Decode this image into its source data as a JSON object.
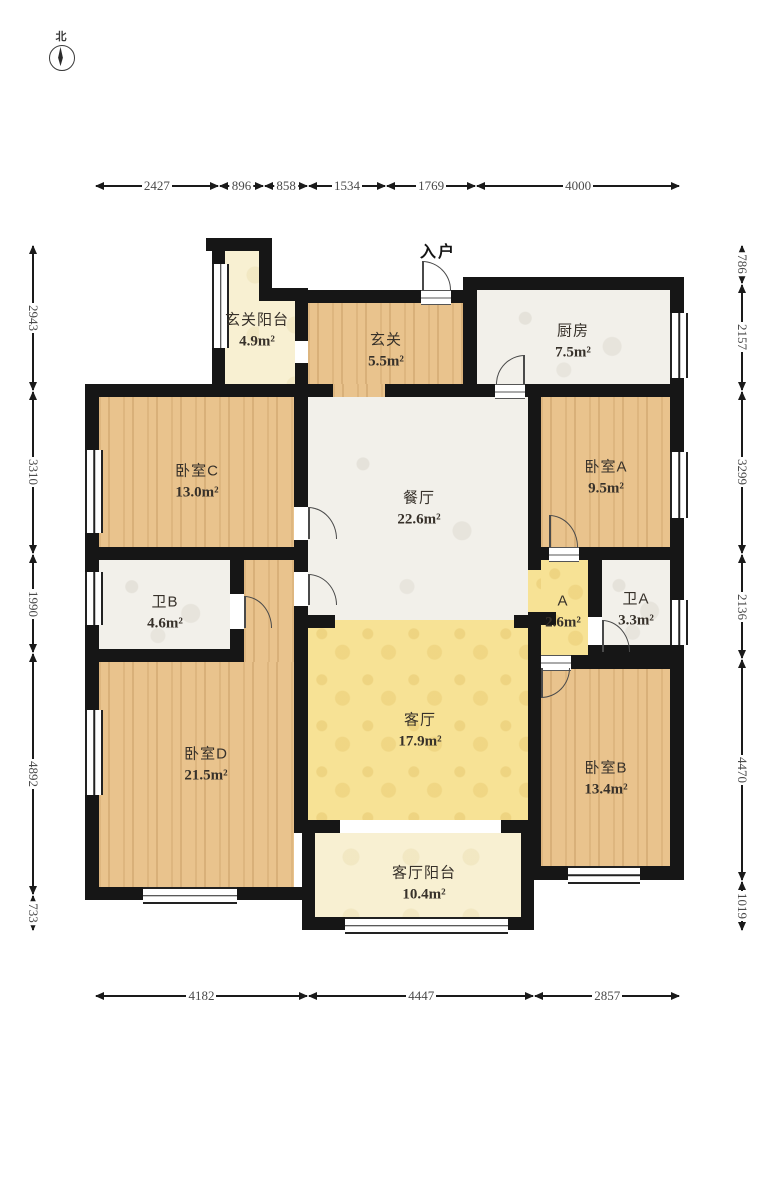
{
  "compass": {
    "north_label": "北"
  },
  "entry": {
    "label": "入户"
  },
  "rooms": [
    {
      "id": "xuanguan-yangtai",
      "name": "玄关阳台",
      "area": "4.9m²"
    },
    {
      "id": "xuanguan",
      "name": "玄关",
      "area": "5.5m²"
    },
    {
      "id": "chufang",
      "name": "厨房",
      "area": "7.5m²"
    },
    {
      "id": "woshi-c",
      "name": "卧室C",
      "area": "13.0m²"
    },
    {
      "id": "canting",
      "name": "餐厅",
      "area": "22.6m²"
    },
    {
      "id": "woshi-a",
      "name": "卧室A",
      "area": "9.5m²"
    },
    {
      "id": "wei-b",
      "name": "卫B",
      "area": "4.6m²"
    },
    {
      "id": "corridor-a",
      "name": "A",
      "area": "2.6m²"
    },
    {
      "id": "wei-a",
      "name": "卫A",
      "area": "3.3m²"
    },
    {
      "id": "woshi-d",
      "name": "卧室D",
      "area": "21.5m²"
    },
    {
      "id": "keting",
      "name": "客厅",
      "area": "17.9m²"
    },
    {
      "id": "woshi-b",
      "name": "卧室B",
      "area": "13.4m²"
    },
    {
      "id": "keting-yangtai",
      "name": "客厅阳台",
      "area": "10.4m²"
    }
  ],
  "dimensions": {
    "top": [
      "2427",
      "896",
      "858",
      "1534",
      "1769",
      "4000"
    ],
    "bottom": [
      "4182",
      "4447",
      "2857"
    ],
    "left": [
      "2943",
      "3310",
      "1990",
      "4892",
      "733"
    ],
    "right": [
      "786",
      "2157",
      "3299",
      "2136",
      "4470",
      "1019"
    ]
  },
  "colors": {
    "wall": "#161616",
    "wood": "#e9c38d",
    "marble": "#f2f0ea",
    "yellow": "#f7e295",
    "cream": "#f8f0d2",
    "dim_text": "#4a4a4a"
  }
}
